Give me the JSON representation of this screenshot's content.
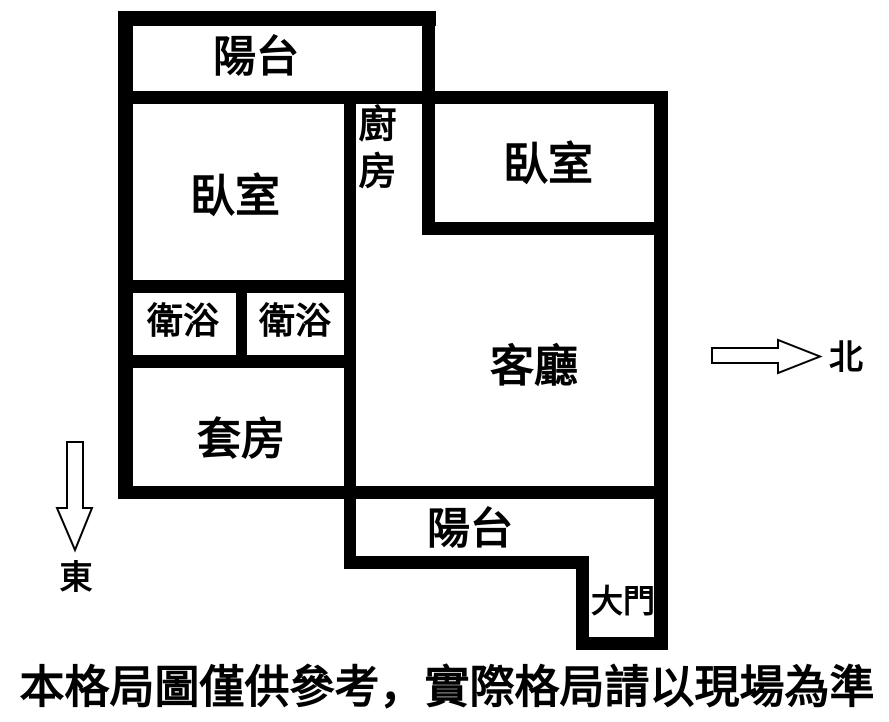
{
  "rooms": {
    "balcony_top": "陽台",
    "bedroom_left": "臥室",
    "bedroom_right": "臥室",
    "kitchen": "廚房",
    "bath_left": "衛浴",
    "bath_right": "衛浴",
    "living_room": "客廳",
    "suite": "套房",
    "balcony_bottom": "陽台",
    "main_door": "大門"
  },
  "compass": {
    "north": "北",
    "east": "東"
  },
  "disclaimer": "本格局圖僅供參考，實際格局請以現場為準",
  "colors": {
    "wall": "#000000",
    "background": "#ffffff",
    "arrow_fill": "#ffffff",
    "arrow_outline": "#000000",
    "text": "#000000"
  }
}
